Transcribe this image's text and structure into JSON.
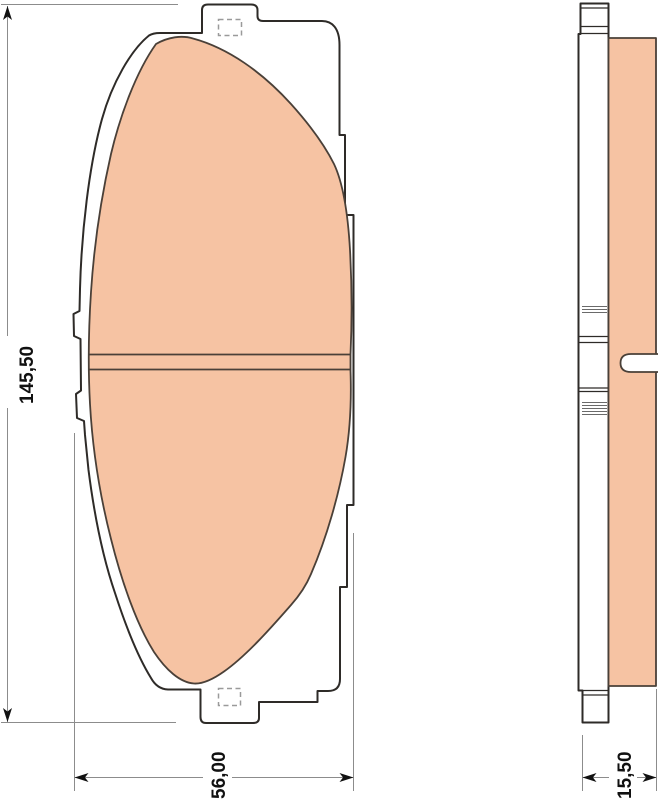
{
  "drawing": {
    "dimensions": {
      "height": "145,50",
      "width": "56,00",
      "thickness": "15,50"
    },
    "colors": {
      "friction_material": "#f6c3a3",
      "plate_fill": "#ffffff",
      "outline": "#2e2b28",
      "friction_outline": "#4a4038",
      "dimension_line": "#8c8c8c",
      "dimension_text": "#111111",
      "hole_marker": "#9a9a9a",
      "background": "#ffffff"
    }
  }
}
